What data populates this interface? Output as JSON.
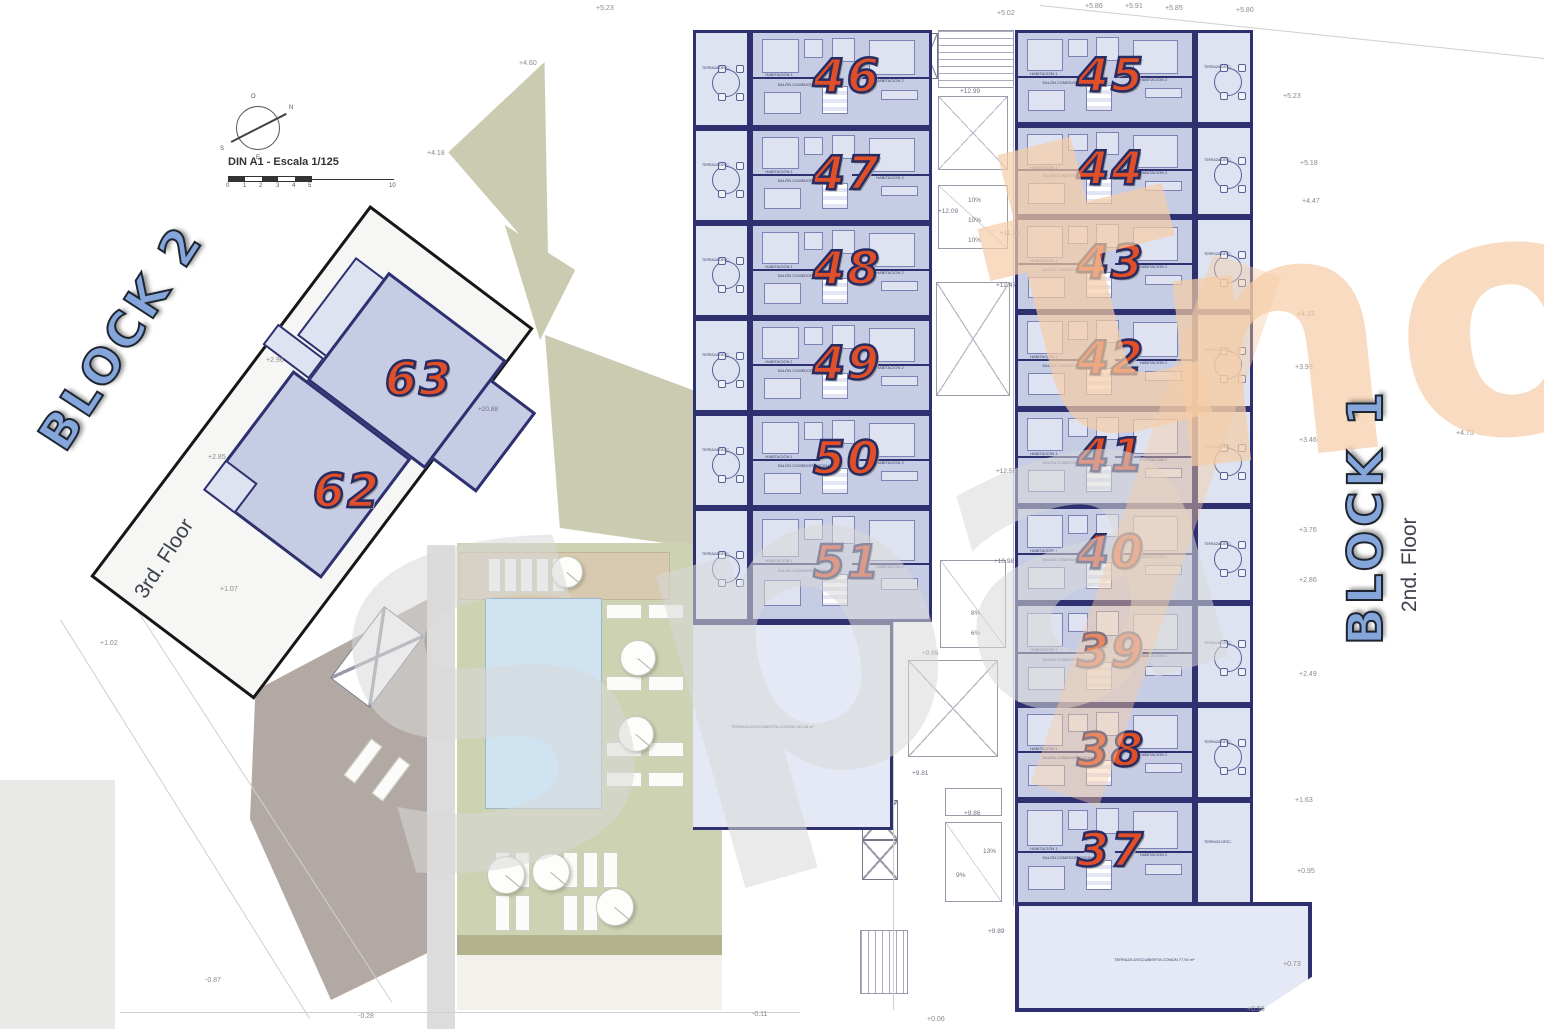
{
  "drawing": {
    "scale_label": "DIN A1 - Escala 1/125",
    "scale_ticks": [
      "0",
      "1",
      "2",
      "3",
      "4",
      "5",
      "10"
    ],
    "compass": {
      "top": "O",
      "right": "N",
      "left": "S",
      "bottom": "E"
    }
  },
  "watermark": {
    "gray_text": "Spa",
    "orange_t": "t",
    "orange_no": "no",
    "gray_color": "#d9d9d9",
    "orange_color": "#f6cda6"
  },
  "block2": {
    "label": "BLOCK 2",
    "floor": "3rd. Floor",
    "units": [
      {
        "number": "63"
      },
      {
        "number": "62"
      }
    ]
  },
  "block1": {
    "label": "BLOCK 1",
    "floor": "2nd. Floor",
    "left_units": [
      {
        "number": "46"
      },
      {
        "number": "47"
      },
      {
        "number": "48"
      },
      {
        "number": "49"
      },
      {
        "number": "50"
      },
      {
        "number": "51"
      }
    ],
    "right_units": [
      {
        "number": "45"
      },
      {
        "number": "44"
      },
      {
        "number": "43"
      },
      {
        "number": "42"
      },
      {
        "number": "41"
      },
      {
        "number": "40"
      },
      {
        "number": "39"
      },
      {
        "number": "38"
      },
      {
        "number": "37"
      }
    ],
    "common_terrace_left": "TERRAZA DESCUBIERTA COMÚN 131,06 m²",
    "common_terrace_bottom": "TERRAZA DESCUBIERTA COMÚN 77,94 m²",
    "apartment_labels": {
      "living": "SALÓN COMEDOR COCINA",
      "bed1": "HABITACIÓN 1",
      "bed2": "HABITACIÓN 2",
      "bath": "BAÑO 1",
      "terrace": "TERRAZA DESC."
    }
  },
  "elevations": [
    {
      "t": "+5.23",
      "x": 596,
      "y": 5
    },
    {
      "t": "+4.60",
      "x": 519,
      "y": 60
    },
    {
      "t": "+4.18",
      "x": 427,
      "y": 150
    },
    {
      "t": "+5.02",
      "x": 997,
      "y": 10
    },
    {
      "t": "+5.86",
      "x": 1085,
      "y": 3
    },
    {
      "t": "+5.91",
      "x": 1125,
      "y": 3
    },
    {
      "t": "+5.85",
      "x": 1165,
      "y": 5
    },
    {
      "t": "+5.80",
      "x": 1236,
      "y": 7
    },
    {
      "t": "+5.23",
      "x": 1283,
      "y": 93
    },
    {
      "t": "+5.18",
      "x": 1300,
      "y": 160
    },
    {
      "t": "+4.47",
      "x": 1302,
      "y": 198
    },
    {
      "t": "+4.23",
      "x": 1297,
      "y": 311
    },
    {
      "t": "+3.93",
      "x": 1295,
      "y": 364
    },
    {
      "t": "+3.46",
      "x": 1299,
      "y": 437
    },
    {
      "t": "+3.76",
      "x": 1299,
      "y": 527
    },
    {
      "t": "+2.86",
      "x": 1299,
      "y": 577
    },
    {
      "t": "+2.49",
      "x": 1299,
      "y": 671
    },
    {
      "t": "+1.63",
      "x": 1295,
      "y": 797
    },
    {
      "t": "+0.95",
      "x": 1297,
      "y": 868
    },
    {
      "t": "+0.73",
      "x": 1283,
      "y": 961
    },
    {
      "t": "+0.56",
      "x": 1247,
      "y": 1006
    },
    {
      "t": "-0.87",
      "x": 205,
      "y": 977
    },
    {
      "t": "-0.28",
      "x": 358,
      "y": 1013
    },
    {
      "t": "-0.11",
      "x": 752,
      "y": 1011
    },
    {
      "t": "+0.06",
      "x": 927,
      "y": 1016
    },
    {
      "t": "+2.96",
      "x": 266,
      "y": 357
    },
    {
      "t": "+2.85",
      "x": 208,
      "y": 454
    },
    {
      "t": "+1.07",
      "x": 220,
      "y": 586
    },
    {
      "t": "+1.02",
      "x": 100,
      "y": 640
    },
    {
      "t": "+4.73",
      "x": 1456,
      "y": 430
    }
  ],
  "core_labels": [
    {
      "t": "+12.99",
      "x": 960,
      "y": 88
    },
    {
      "t": "+12.09",
      "x": 938,
      "y": 208
    },
    {
      "t": "+11.78",
      "x": 1000,
      "y": 230
    },
    {
      "t": "10%",
      "x": 968,
      "y": 197
    },
    {
      "t": "10%",
      "x": 968,
      "y": 217
    },
    {
      "t": "10%",
      "x": 968,
      "y": 237
    },
    {
      "t": "+12.47",
      "x": 996,
      "y": 282
    },
    {
      "t": "+12.58",
      "x": 996,
      "y": 468
    },
    {
      "t": "+10.98",
      "x": 994,
      "y": 558
    },
    {
      "t": "8%",
      "x": 971,
      "y": 610
    },
    {
      "t": "6%",
      "x": 971,
      "y": 630
    },
    {
      "t": "+9.85",
      "x": 922,
      "y": 650
    },
    {
      "t": "+9.81",
      "x": 912,
      "y": 770
    },
    {
      "t": "+9.86",
      "x": 964,
      "y": 810
    },
    {
      "t": "13%",
      "x": 983,
      "y": 848
    },
    {
      "t": "9%",
      "x": 956,
      "y": 872
    },
    {
      "t": "+9.89",
      "x": 988,
      "y": 928
    },
    {
      "t": "+20.88",
      "x": 478,
      "y": 406
    }
  ],
  "colors": {
    "wall_navy": "#2f3070",
    "apartment_fill": "#c6cce4",
    "terrace_fill": "#dde3f1",
    "common_terrace_fill": "#e4e9f5",
    "unit_number": "#e14f28",
    "unit_number_outline": "#272c63",
    "block_label_fill": "#85a6da",
    "landscape_beige": "#cbcbb1",
    "deck_green": "#cdd2b2",
    "pool_blue": "#cfe3f1",
    "roof_taupe": "#b3a9a4"
  }
}
